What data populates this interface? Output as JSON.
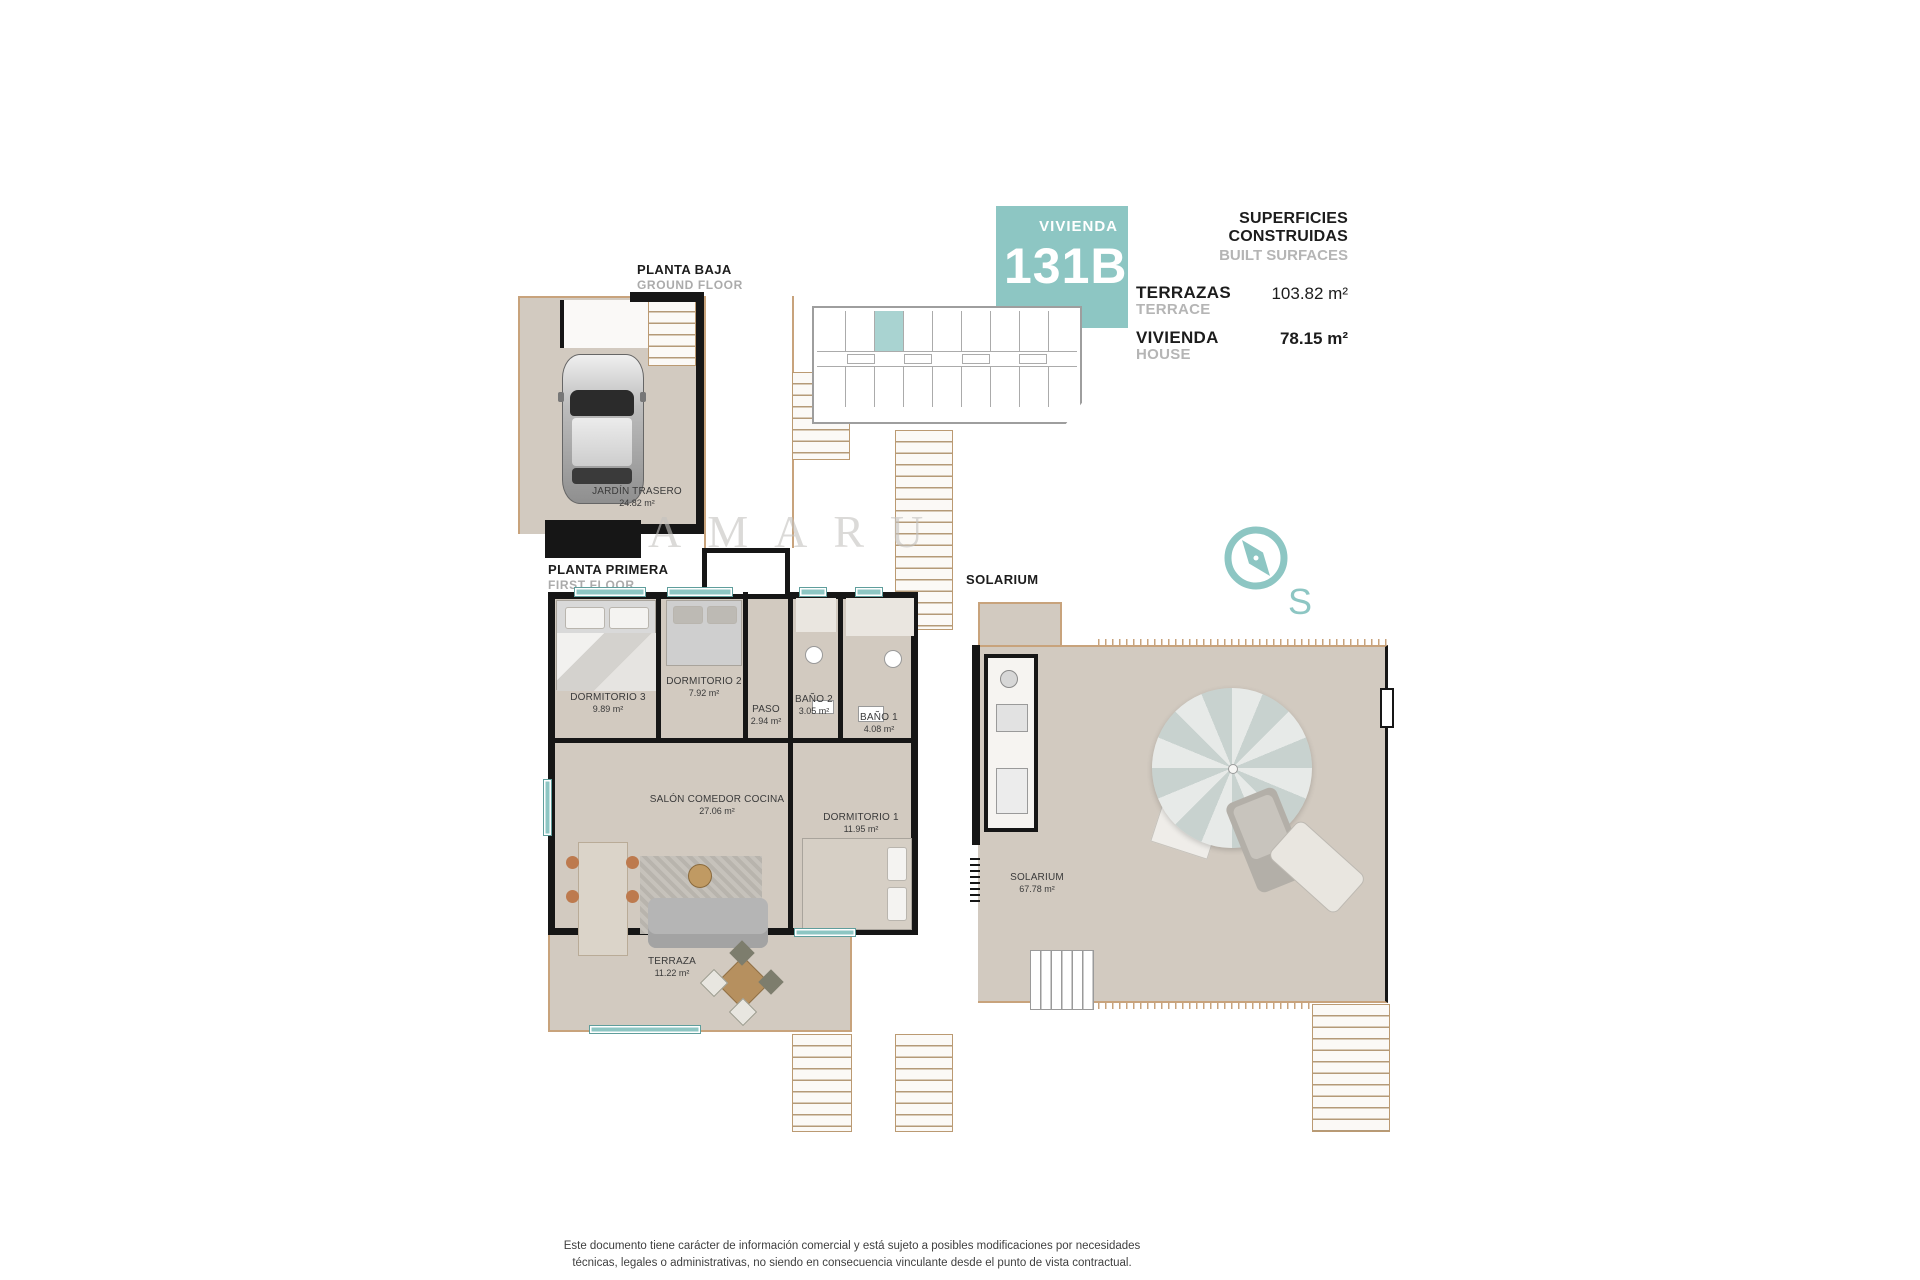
{
  "colors": {
    "teal": "#8dc6c3",
    "tealLight": "#a9d3d1",
    "floor": "#d2cac0",
    "tan": "#c8a37c",
    "wall": "#161616",
    "gray": "#ababab"
  },
  "watermark": "AMARU",
  "header": {
    "badge_label": "VIVIENDA",
    "badge_number": "131B",
    "title": "SUPERFICIES CONSTRUIDAS",
    "subtitle": "BUILT SURFACES",
    "rows": [
      {
        "label": "TERRAZAS",
        "sublabel": "TERRACE",
        "value": "103.82 m²"
      },
      {
        "label": "VIVIENDA",
        "sublabel": "HOUSE",
        "value": "78.15 m²"
      }
    ]
  },
  "plans": {
    "ground": {
      "title": "PLANTA BAJA",
      "subtitle": "GROUND FLOOR",
      "rooms": [
        {
          "name": "JARDÍN TRASERO",
          "area": "24.82 m²"
        }
      ]
    },
    "first": {
      "title": "PLANTA PRIMERA",
      "subtitle": "FIRST FLOOR",
      "rooms": [
        {
          "name": "DORMITORIO 3",
          "area": "9.89 m²"
        },
        {
          "name": "DORMITORIO 2",
          "area": "7.92 m²"
        },
        {
          "name": "PASO",
          "area": "2.94 m²"
        },
        {
          "name": "BAÑO 2",
          "area": "3.05 m²"
        },
        {
          "name": "BAÑO 1",
          "area": "4.08 m²"
        },
        {
          "name": "SALÓN COMEDOR COCINA",
          "area": "27.06 m²"
        },
        {
          "name": "DORMITORIO 1",
          "area": "11.95 m²"
        },
        {
          "name": "TERRAZA",
          "area": "11.22 m²"
        }
      ]
    },
    "solarium": {
      "title": "SOLARIUM",
      "rooms": [
        {
          "name": "SOLARIUM",
          "area": "67.78 m²"
        }
      ]
    }
  },
  "compass": {
    "south_label": "S"
  },
  "footer": {
    "line1": "Este documento tiene carácter de información comercial y está sujeto a posibles modificaciones por necesidades",
    "line2": "técnicas, legales o administrativas, no siendo en consecuencia vinculante desde el punto de vista contractual."
  }
}
